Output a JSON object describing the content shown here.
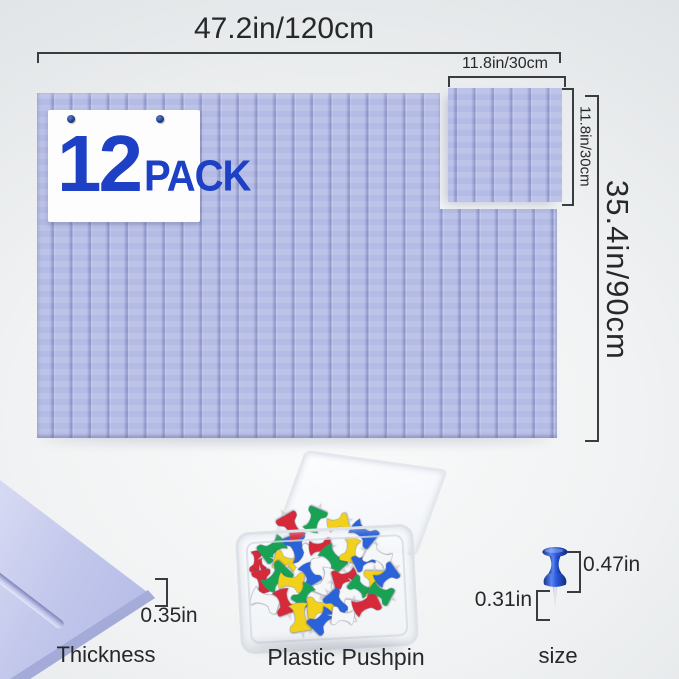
{
  "dims": {
    "board_width": "47.2in/120cm",
    "board_height": "35.4in/90cm",
    "tile_width": "11.8in/30cm",
    "tile_height": "11.8in/30cm",
    "thickness": "0.35in",
    "pin_head_height": "0.47in",
    "pin_needle_length": "0.31in"
  },
  "labels": {
    "thickness": "Thickness",
    "pushpin_box": "Plastic Pushpin",
    "pin_size": "size"
  },
  "badge": {
    "count": "12",
    "unit": "PACK"
  },
  "colors": {
    "felt_base": "#b9c0e8",
    "felt_mid": "#aab1de",
    "felt_groove": "#939bce",
    "felt_dark": "#8e96c8",
    "felt_light": "#ccd1f2",
    "accent_blue": "#1d40c4",
    "card_pin_navy": "#1e3a80",
    "dim_line": "#3a3d40",
    "dim_text": "#26282a",
    "pin_blue": "#2457d6",
    "pushpin_colors": [
      "#d6293a",
      "#18a254",
      "#f2d11c",
      "#2a62d9",
      "#f5f6f8"
    ]
  }
}
